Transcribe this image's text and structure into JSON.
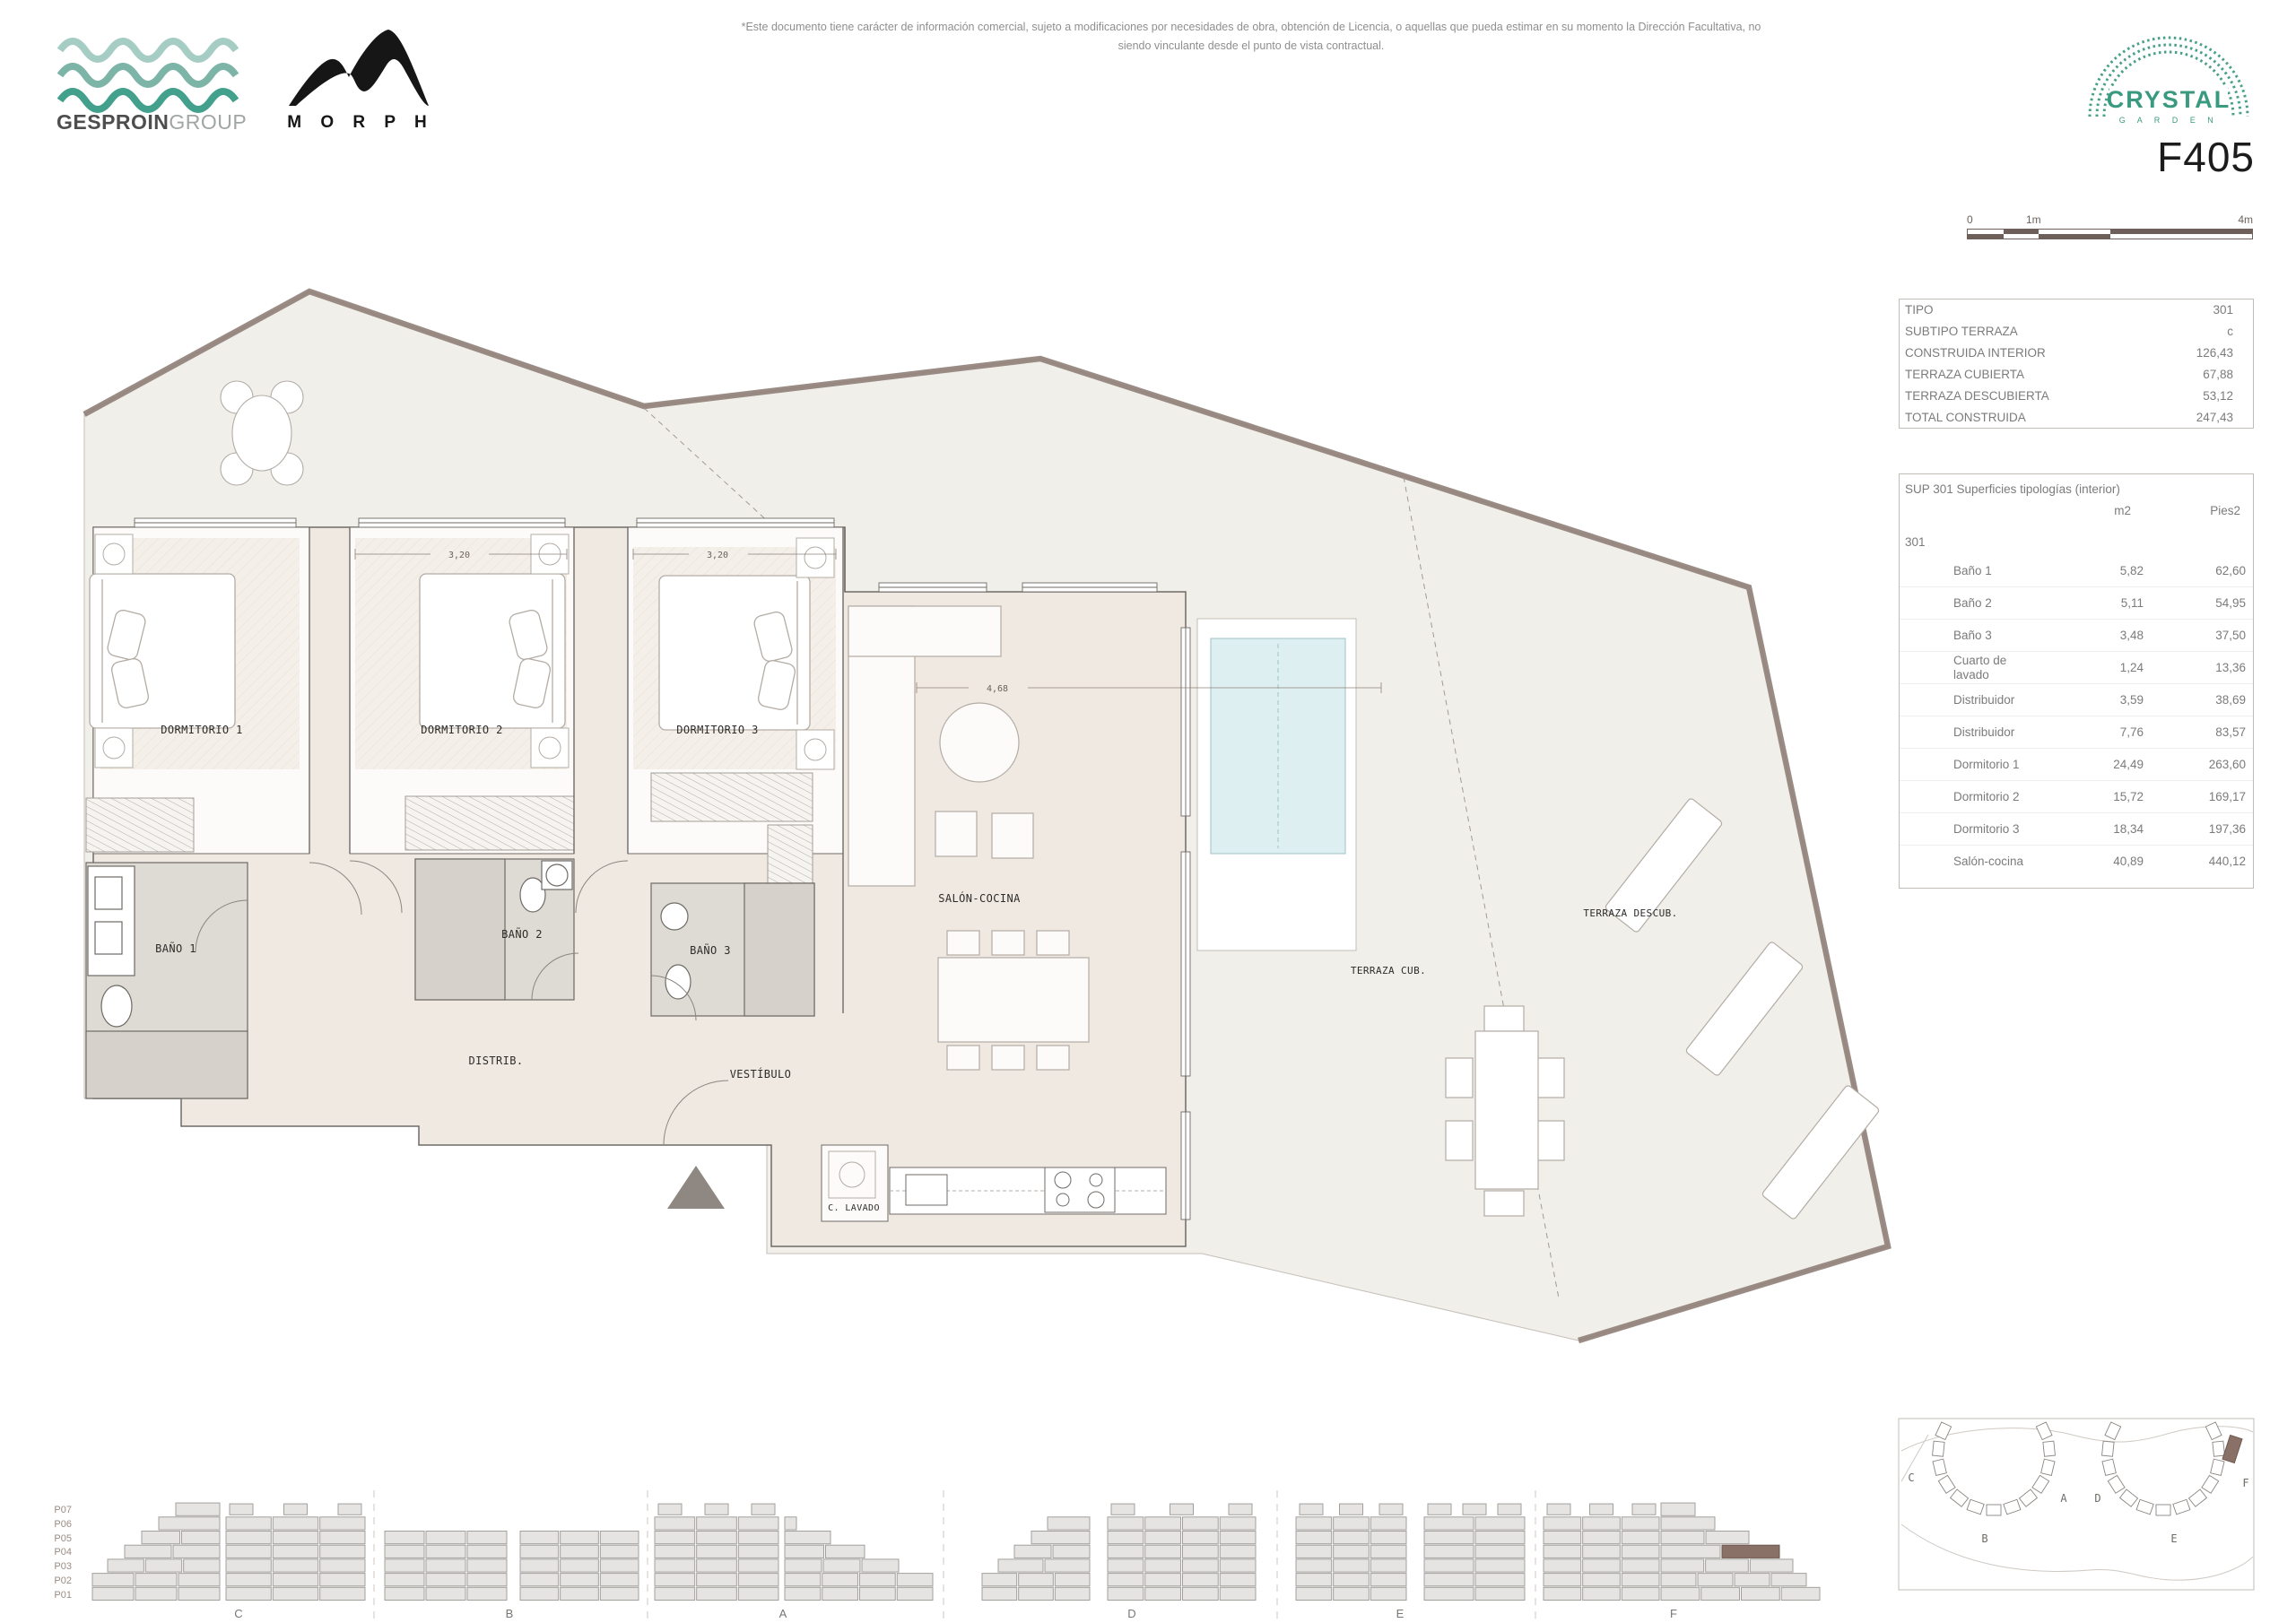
{
  "header": {
    "gesproin_bold": "GESPROIN",
    "gesproin_light": "GROUP",
    "morph_label": "M O R P H",
    "disclaimer_line1": "*Este documento tiene carácter de información comercial, sujeto a modificaciones por necesidades de obra, obtención de Licencia, o aquellas que pueda estimar en su momento la Dirección Facultativa, no",
    "disclaimer_line2": "siendo vinculante desde el punto de vista contractual.",
    "crystal_name": "CRYSTAL",
    "crystal_sub": "G A R D E N",
    "unit_code": "F405"
  },
  "scale_bar": {
    "zero": "0",
    "one": "1m",
    "four": "4m"
  },
  "summary_table": {
    "rows": [
      {
        "label": "TIPO",
        "value": "301"
      },
      {
        "label": "SUBTIPO TERRAZA",
        "value": "c"
      },
      {
        "label": "CONSTRUIDA INTERIOR",
        "value": "126,43"
      },
      {
        "label": "TERRAZA CUBIERTA",
        "value": "67,88"
      },
      {
        "label": "TERRAZA DESCUBIERTA",
        "value": "53,12"
      },
      {
        "label": "TOTAL CONSTRUIDA",
        "value": "247,43"
      }
    ]
  },
  "surfaces_table": {
    "title": "SUP 301 Superficies tipologías (interior)",
    "col_m2": "m2",
    "col_pies2": "Pies2",
    "group_label": "301",
    "rows": [
      {
        "name": "Baño 1",
        "m2": "5,82",
        "pies2": "62,60"
      },
      {
        "name": "Baño 2",
        "m2": "5,11",
        "pies2": "54,95"
      },
      {
        "name": "Baño 3",
        "m2": "3,48",
        "pies2": "37,50"
      },
      {
        "name": "Cuarto de lavado",
        "m2": "1,24",
        "pies2": "13,36"
      },
      {
        "name": "Distribuidor",
        "m2": "3,59",
        "pies2": "38,69"
      },
      {
        "name": "Distribuidor",
        "m2": "7,76",
        "pies2": "83,57"
      },
      {
        "name": "Dormitorio 1",
        "m2": "24,49",
        "pies2": "263,60"
      },
      {
        "name": "Dormitorio 2",
        "m2": "15,72",
        "pies2": "169,17"
      },
      {
        "name": "Dormitorio 3",
        "m2": "18,34",
        "pies2": "197,36"
      },
      {
        "name": "Salón-cocina",
        "m2": "40,89",
        "pies2": "440,12"
      }
    ]
  },
  "plan": {
    "rooms": {
      "dormitorio1": "DORMITORIO 1",
      "dormitorio2": "DORMITORIO 2",
      "dormitorio3": "DORMITORIO 3",
      "bano1": "BAÑO 1",
      "bano2": "BAÑO 2",
      "bano3": "BAÑO 3",
      "distribuidor": "DISTRIB.",
      "vestibulo": "VESTÍBULO",
      "salon": "SALÓN-COCINA",
      "lavado": "C. LAVADO",
      "terraza_cub": "TERRAZA CUB.",
      "terraza_descub": "TERRAZA DESCUB."
    },
    "dimensions": {
      "dorm2": "3,20",
      "dorm3": "3,20",
      "salon": "4,68"
    }
  },
  "elevations": {
    "floor_labels": [
      "P07",
      "P06",
      "P05",
      "P04",
      "P03",
      "P02",
      "P01"
    ],
    "groups": [
      "C",
      "B",
      "A",
      "D",
      "E",
      "F"
    ]
  },
  "site_plan": {
    "labels": [
      "C",
      "B",
      "A",
      "D",
      "E",
      "F"
    ]
  },
  "colors": {
    "teal_dark": "#3f9b87",
    "crystal_green": "#3a9a80",
    "highlight": "#8a7168",
    "highlight_stroke": "#6e584e",
    "block_fill": "#e5e4e2",
    "block_stroke": "#a3a09c"
  }
}
